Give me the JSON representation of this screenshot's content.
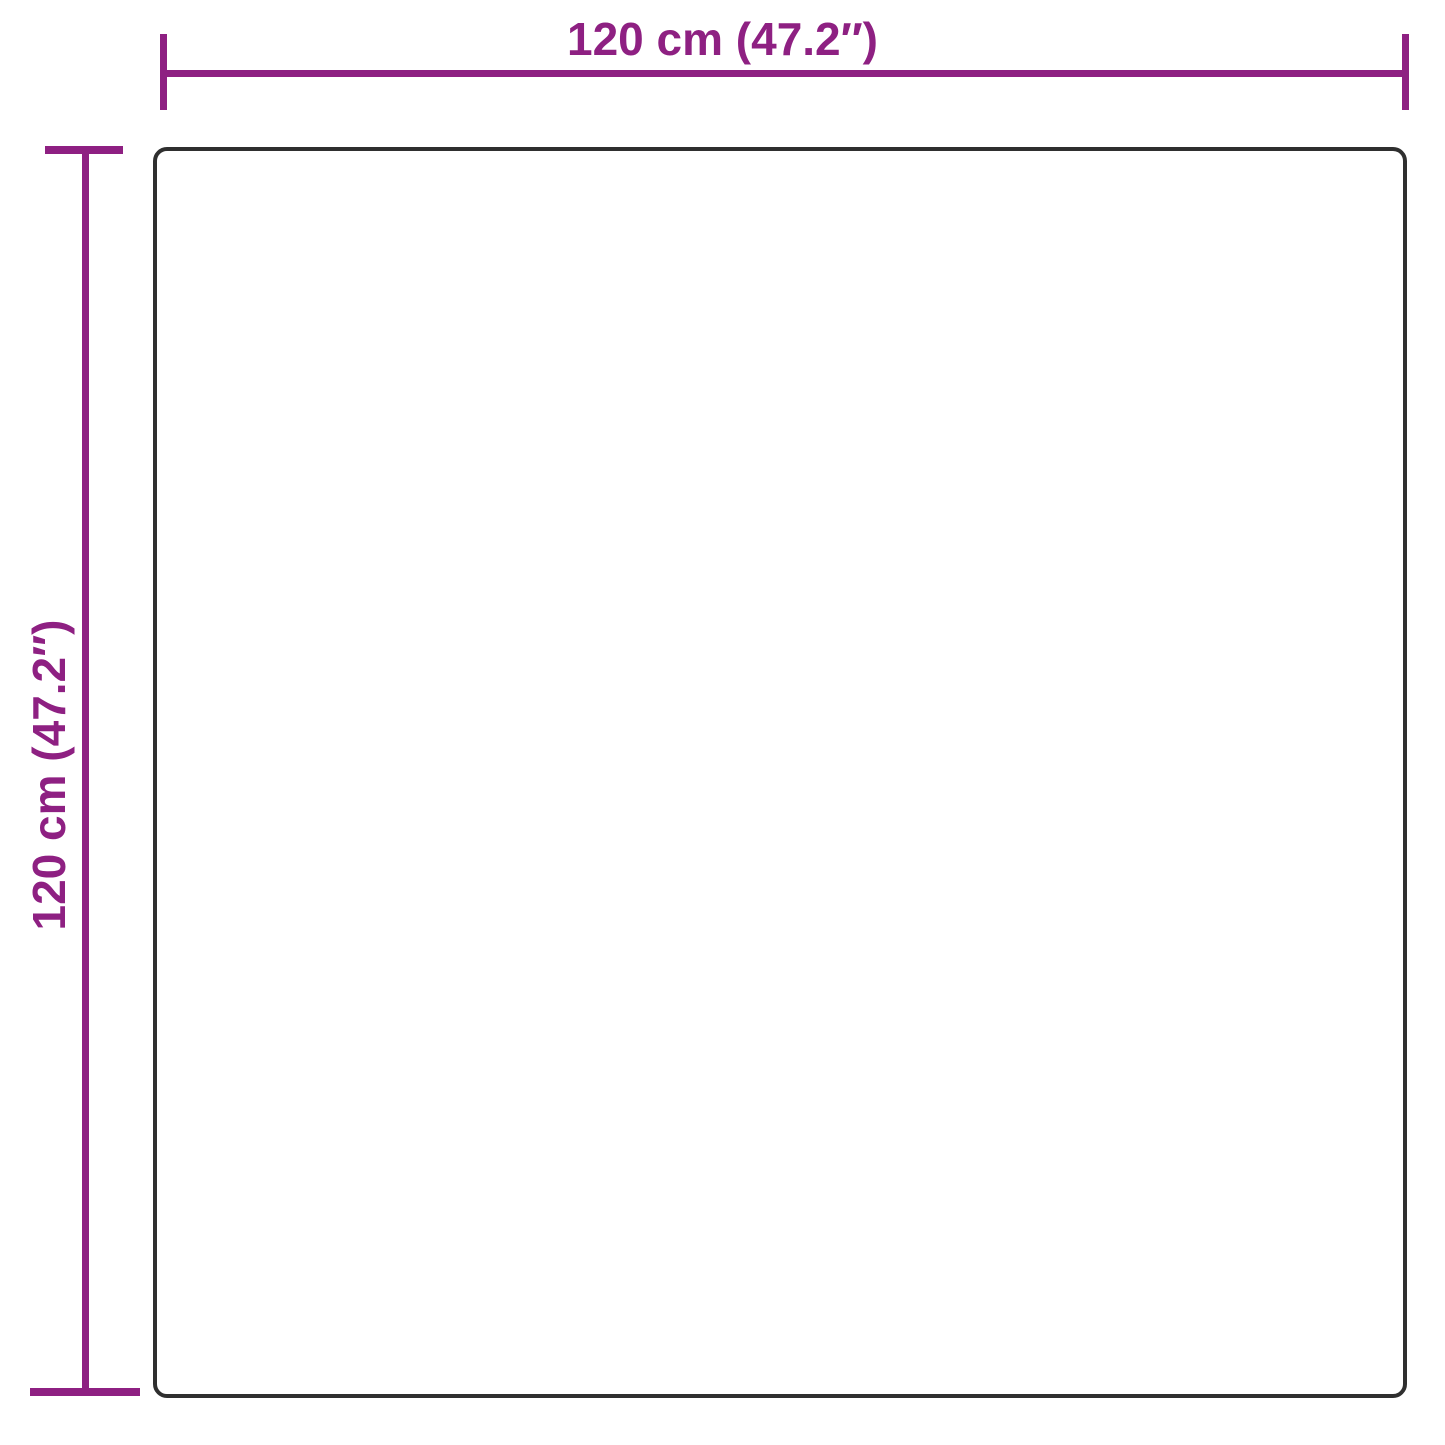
{
  "page": {
    "background_color": "#FFFFFF"
  },
  "diagram": {
    "type": "product-dimension-diagram",
    "shape": "rounded-square-outline",
    "outline_color": "#2F2F2F",
    "dimension_color": "#8E2082",
    "width": {
      "label": "120 cm (47.2″)"
    },
    "height": {
      "label": "120 cm (47.2″)"
    }
  }
}
